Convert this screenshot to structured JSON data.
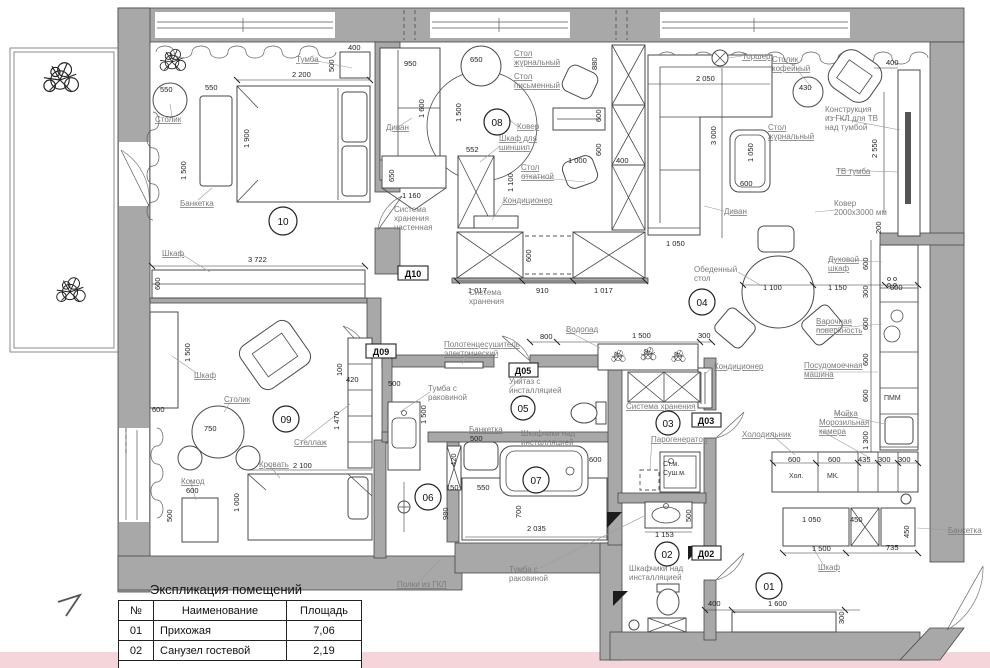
{
  "colors": {
    "wall": "#a8a8a8",
    "label": "#7b7b7b",
    "pink": "#f6d5da",
    "line": "#3d3d3d"
  },
  "legend": {
    "title": "Экспликация помещений",
    "col_no": "№",
    "col_name": "Наименование",
    "col_area": "Площадь",
    "rows": [
      {
        "no": "01",
        "name": "Прихожая",
        "area": "7,06"
      },
      {
        "no": "02",
        "name": "Санузел гостевой",
        "area": "2,19"
      }
    ]
  },
  "rooms": {
    "r01": "01",
    "r02": "02",
    "r03": "03",
    "r04": "04",
    "r05": "05",
    "r06": "06",
    "r07": "07",
    "r08": "08",
    "r09": "09",
    "r10": "10"
  },
  "doors": {
    "d02": "Д02",
    "d03": "Д03",
    "d05": "Д05",
    "d09": "Д09",
    "d10": "Д10"
  },
  "t": {
    "stolik": "Столик",
    "banketka": "Банкетка",
    "tumba": "Тумба",
    "shkaf": "Шкаф",
    "divan": "Диван",
    "stol": "Стол",
    "zhurnalnyy": "журнальный",
    "pismennyy": "письменный",
    "otkatnoy": "откатной",
    "kover": "Ковер",
    "shkaf_dlya": "Шкаф для",
    "shinshil": "шиншил",
    "konditsioner": "Кондиционер",
    "sistema": "Система",
    "khraneniya": "хранения",
    "nastennaya": "настенная",
    "sistema_khraneniya": "Система хранения",
    "torsher": "Торшер",
    "kofeynyy": "кофейный",
    "konstruktsiya": "Конструкция",
    "iz_gkl": "из ГКЛ для ТВ",
    "nad_tumboy": "над тумбой",
    "tv_tumba": "ТВ тумба",
    "kover_l1": "Ковер",
    "kover_l2": "2000x3000 мм",
    "obedennyy": "Обеденный",
    "stol_lc": "стол",
    "dukhovoy": "Духовой",
    "shkaf_lc": "шкаф",
    "varochnaya": "Варочная",
    "poverkhnost": "поверхность",
    "posudomoechnaya": "Посудомоечная",
    "mashina": "машина",
    "moyka": "Мойка",
    "morozilnaya": "Морозильная",
    "kamera": "камера",
    "kholodilnik": "Холодильник",
    "khol": "Хол.",
    "mk": "МК.",
    "pmm": "ПММ",
    "vodopad": "Водопад",
    "polotentsesushitel": "Полотенцесушитель",
    "elektricheskiy": "электрический",
    "unitaz_s": "Унитаз с",
    "installyatsiey": "инсталляцией",
    "tumba_s": "Тумба с",
    "rakovinoy": "раковиной",
    "shkafchiki_nad": "Шкафчики над",
    "parogenerator": "Парогенератор",
    "st_m": "Ст.м.",
    "sush_m": "Суш.м.",
    "krovat": "Кровать",
    "komod": "Комод",
    "stellazh": "Стеллаж",
    "polki_gkl": "Полки из ГКЛ"
  },
  "dims": {
    "d100": "100",
    "d150": "150",
    "d200": "200",
    "d300": "300",
    "d400": "400",
    "d420": "420",
    "d430": "430",
    "d435": "435",
    "d450": "450",
    "d500": "500",
    "d550": "550",
    "d552": "552",
    "d600": "600",
    "d650": "650",
    "d700": "700",
    "d735": "735",
    "d750": "750",
    "d800": "800",
    "d880": "880",
    "d910": "910",
    "d950": "950",
    "d980": "980",
    "d1000": "1 000",
    "d1017": "1 017",
    "d1050": "1 050",
    "d1100": "1 100",
    "d1150": "1 150",
    "d1153": "1 153",
    "d1160": "1 160",
    "d1300": "1 300",
    "d1470": "1 470",
    "d1500": "1 500",
    "d1600": "1 600",
    "d1900": "1 900",
    "d2035": "2 035",
    "d2050": "2 050",
    "d2100": "2 100",
    "d2200": "2 200",
    "d2550": "2 550",
    "d3000": "3 000",
    "d3722": "3 722"
  }
}
